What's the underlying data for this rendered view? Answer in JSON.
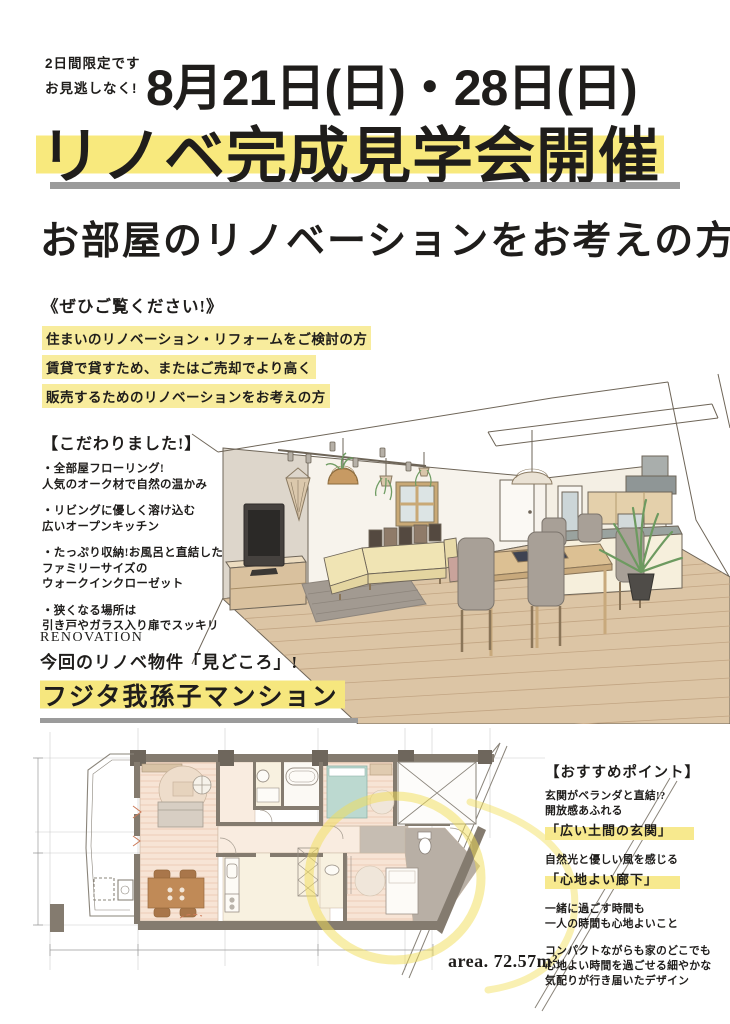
{
  "header": {
    "limited_note": [
      "2日間限定です",
      "お見逃しなく!"
    ],
    "date_line": "8月21日(日)・28日(日)",
    "main_title": "リノベ完成見学会開催"
  },
  "headline": "お部屋のリノベーションをお考えの方",
  "invite": {
    "heading": "《ぜひご覧ください!》",
    "highlight_lines": [
      "住まいのリノベーション・リフォームをご検討の方",
      "賃貸で貸すため、またはご売却でより高く",
      "販売するためのリノベーションをお考えの方"
    ]
  },
  "kodawari": {
    "heading": "【こだわりました!】",
    "items": [
      [
        "・全部屋フローリング!",
        "人気のオーク材で自然の温かみ"
      ],
      [
        "・リビングに優しく溶け込む",
        "広いオープンキッチン"
      ],
      [
        "・たっぷり収納!お風呂と直結した",
        "ファミリーサイズの",
        "ウォークインクローゼット"
      ],
      [
        "・狭くなる場所は",
        "引き戸やガラス入り扉でスッキリ"
      ]
    ]
  },
  "renovation": {
    "label": "RENOVATION",
    "subtitle": "今回のリノベ物件「見どころ」!",
    "property_name": "フジタ我孫子マンション"
  },
  "points": {
    "heading": "【おすすめポイント】",
    "groups": [
      {
        "lines": [
          "玄関がベランダと直結!?",
          "開放感あふれる"
        ],
        "highlight": "「広い土間の玄関」"
      },
      {
        "lines": [
          "自然光と優しい風を感じる"
        ],
        "highlight": "「心地よい廊下」"
      },
      {
        "lines": [
          "一緒に過ごす時間も",
          "一人の時間も心地よいこと"
        ]
      },
      {
        "lines": [
          "コンパクトながらも家のどこでも",
          "心地よい時間を過ごせる細やかな",
          "気配りが行き届いたデザイン"
        ]
      }
    ]
  },
  "floorplan": {
    "area_label": "area. 72.57m²"
  },
  "colors": {
    "highlight_yellow": "#f8e97d",
    "highlight_soft_yellow": "#f8ec9d",
    "divider_gray": "#9b9b9b",
    "text_black": "#1f1d1b",
    "plan_wall": "#847b6f",
    "plan_floor_pink": "#f7e4d5",
    "plan_marker_yellow": "#f2de55",
    "wood_floor": "#dcc5a5"
  }
}
